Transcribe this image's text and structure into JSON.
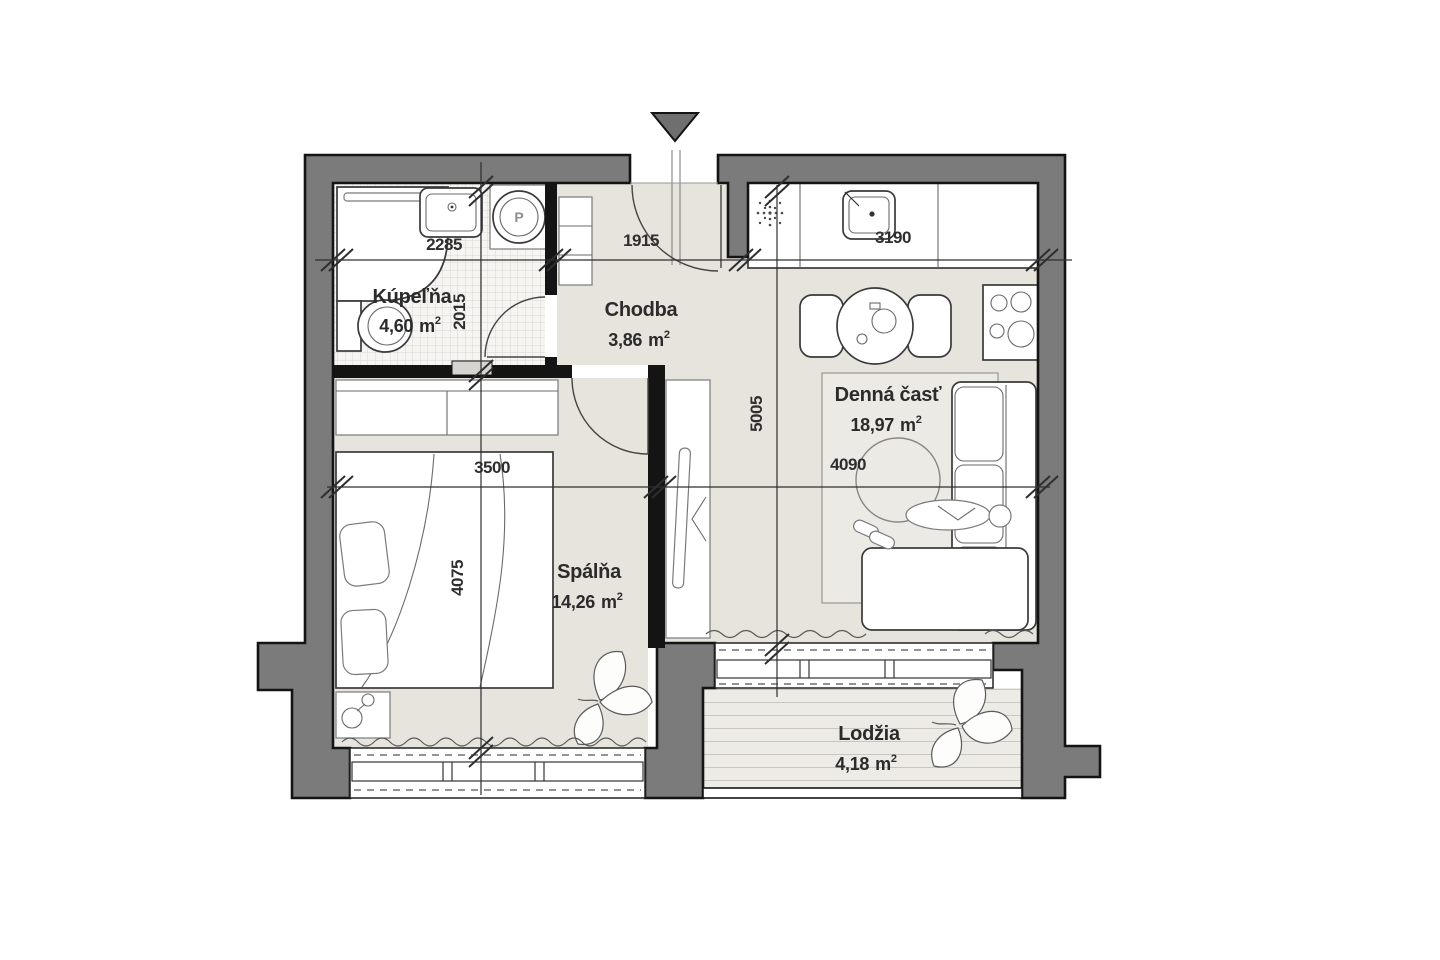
{
  "rooms": {
    "bathroom": {
      "name": "Kúpeľňa",
      "area_value": "4,60"
    },
    "hallway": {
      "name": "Chodba",
      "area_value": "3,86"
    },
    "bedroom": {
      "name": "Spálňa",
      "area_value": "14,26"
    },
    "living": {
      "name": "Denná časť",
      "area_value": "18,97"
    },
    "loggia": {
      "name": "Lodžia",
      "area_value": "4,18"
    }
  },
  "units": {
    "unit": "m",
    "exp": "2"
  },
  "dimensions": {
    "bathroom_width": "2285",
    "hallway_width": "1915",
    "kitchen_width": "3190",
    "bathroom_height": "2015",
    "living_height": "5005",
    "bedroom_width": "3500",
    "living_width": "4090",
    "bedroom_height": "4075"
  },
  "symbols": {
    "washer_label": "P"
  },
  "colors": {
    "wall": "#7b7b7b",
    "outline": "#141414",
    "floor": "#e7e4de",
    "accent_triangle": "#6f6f6f"
  }
}
